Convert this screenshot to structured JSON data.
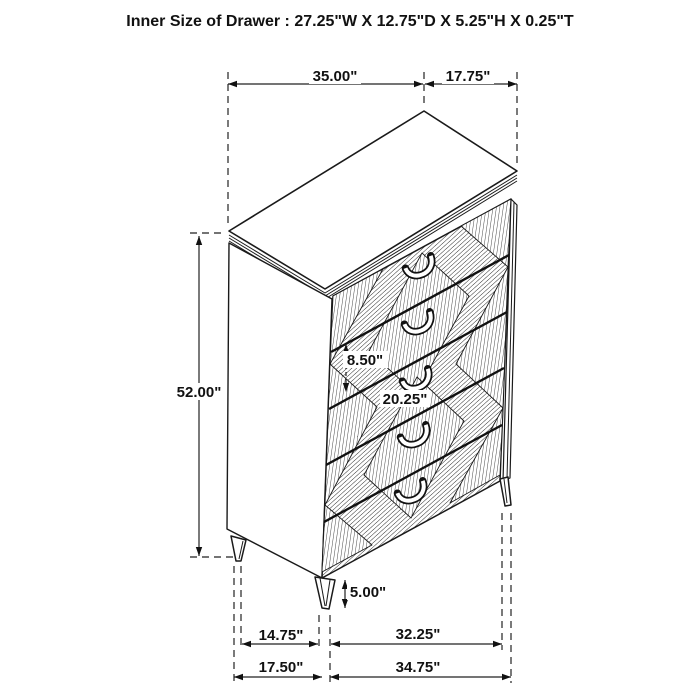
{
  "title": "Inner Size of Drawer : 27.25\"W X 12.75\"D X 5.25\"H X 0.25\"T",
  "diagram": {
    "type": "furniture-dimension-diagram",
    "item": "5-drawer chest with diamond-pattern drawer fronts and tapered legs",
    "drawer_count": 5,
    "colors": {
      "line": "#1a1a1a",
      "background": "#ffffff"
    }
  },
  "dims": {
    "top_width": "35.00\"",
    "top_depth": "17.75\"",
    "height": "52.00\"",
    "drawer_height": "8.50\"",
    "drawer_width": "20.25\"",
    "leg_height": "5.00\"",
    "bottom_side_inner": "14.75\"",
    "bottom_front_inner": "32.25\"",
    "bottom_side_outer": "17.50\"",
    "bottom_front_outer": "34.75\""
  }
}
